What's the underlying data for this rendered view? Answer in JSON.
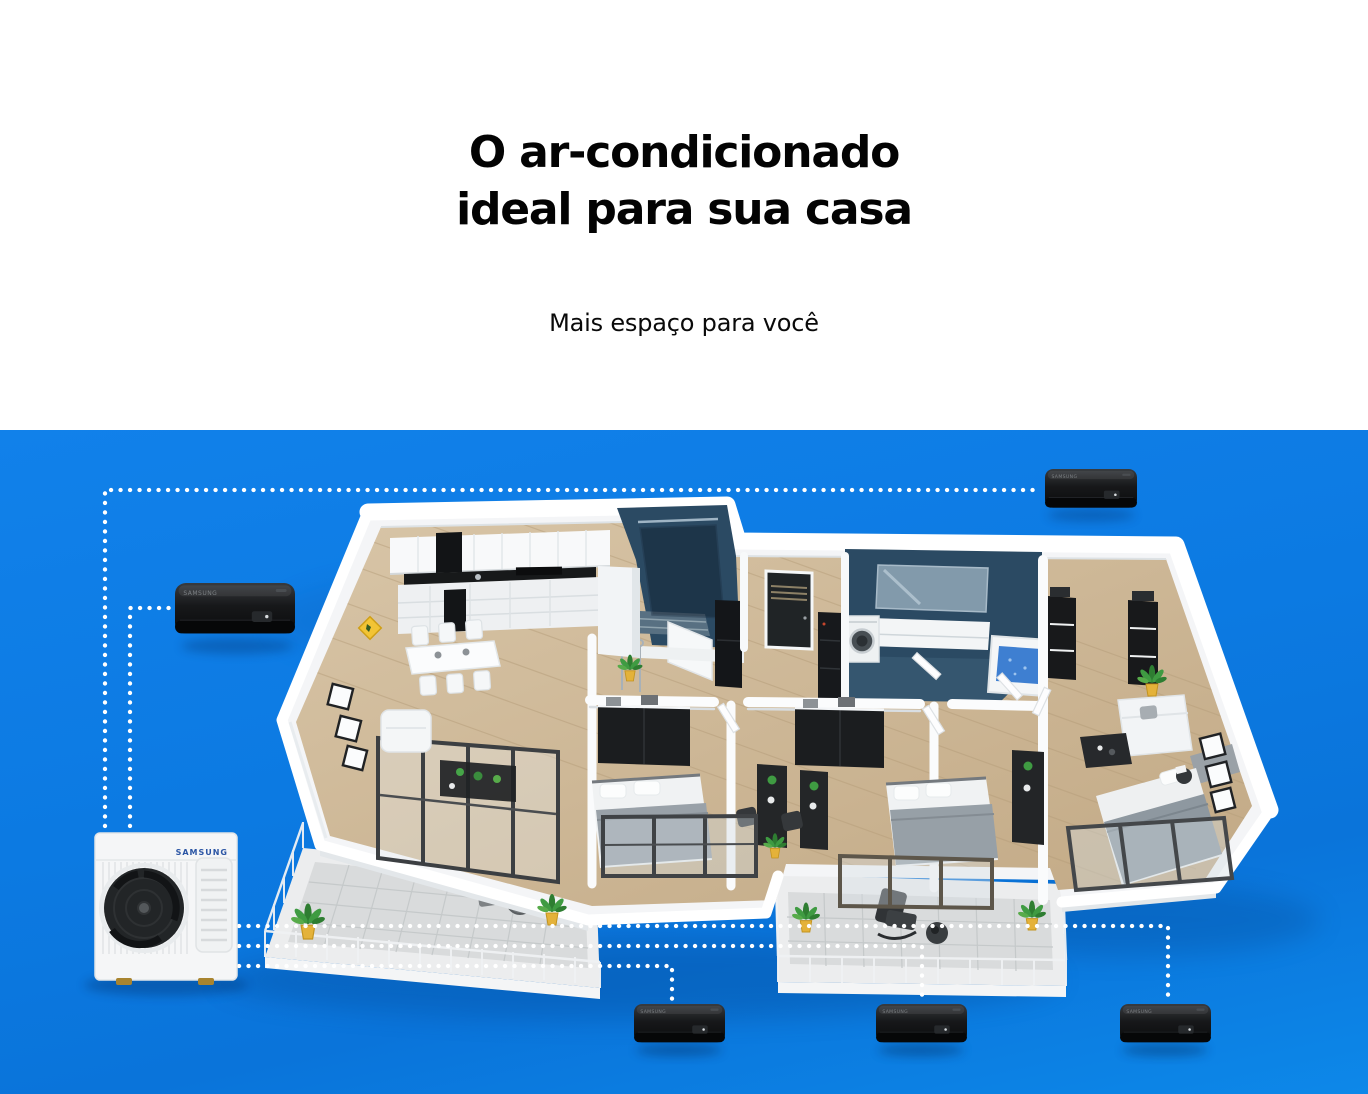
{
  "header": {
    "title_line1": "O ar-condicionado",
    "title_line2": "ideal para sua casa",
    "subtitle": "Mais espaço para você"
  },
  "scene": {
    "outdoor_brand": "SAMSUNG",
    "indoor_brand": "SAMSUNG",
    "indoor_unit_count": 5,
    "outdoor_unit_count": 1,
    "palette": {
      "background_blue_top": "#1181ea",
      "background_blue_bottom": "#0a74da",
      "dotted_line": "#ffffff",
      "indoor_unit_black": "#101113",
      "outdoor_unit_white": "#f5f6f7",
      "samsung_logo_blue": "#2b55a4",
      "wood_floor": "#cdb795",
      "bathroom_tile": "#2b4a63",
      "balcony_tile": "#d9dbdc",
      "warning_sign_yellow": "#f2c435",
      "plant_green": "#3f9b42"
    }
  }
}
